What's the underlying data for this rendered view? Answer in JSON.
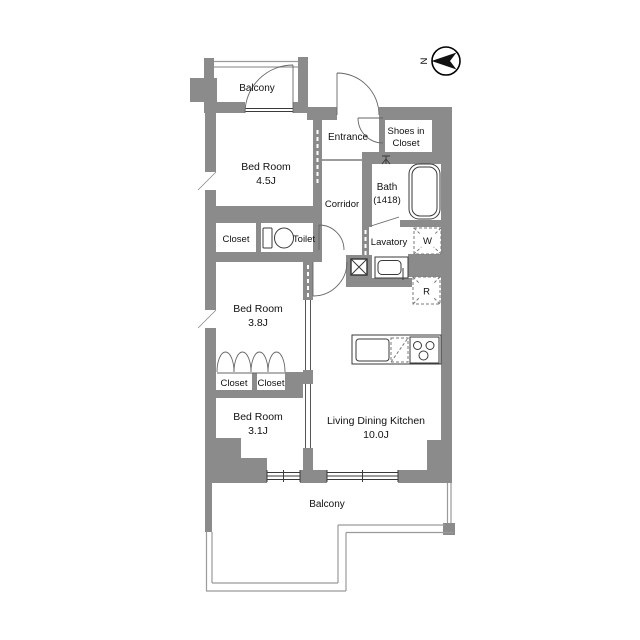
{
  "compass": {
    "north_label": "N"
  },
  "rooms": {
    "balcony_top": {
      "label": "Balcony"
    },
    "bedroom_45": {
      "label": "Bed Room",
      "size": "4.5J"
    },
    "entrance": {
      "label": "Entrance"
    },
    "shoes_in_closet": {
      "line1": "Shoes in",
      "line2": "Closet"
    },
    "corridor": {
      "label": "Corridor"
    },
    "bath": {
      "label": "Bath",
      "size": "(1418)"
    },
    "closet_north": {
      "label": "Closet"
    },
    "toilet": {
      "label": "Toilet"
    },
    "lavatory": {
      "label": "Lavatory"
    },
    "washer": {
      "label": "W"
    },
    "refrigerator": {
      "label": "R"
    },
    "bedroom_38": {
      "label": "Bed Room",
      "size": "3.8J"
    },
    "closet_west": {
      "label": "Closet"
    },
    "closet_east": {
      "label": "Closet"
    },
    "bedroom_31": {
      "label": "Bed Room",
      "size": "3.1J"
    },
    "ldk": {
      "label": "Living Dining Kitchen",
      "size": "10.0J"
    },
    "balcony_bottom": {
      "label": "Balcony"
    }
  },
  "colors": {
    "wall": "#8b8b8b",
    "line": "#3a3a3a",
    "railing": "#9a9a9a",
    "text": "#111111",
    "background": "#ffffff"
  }
}
